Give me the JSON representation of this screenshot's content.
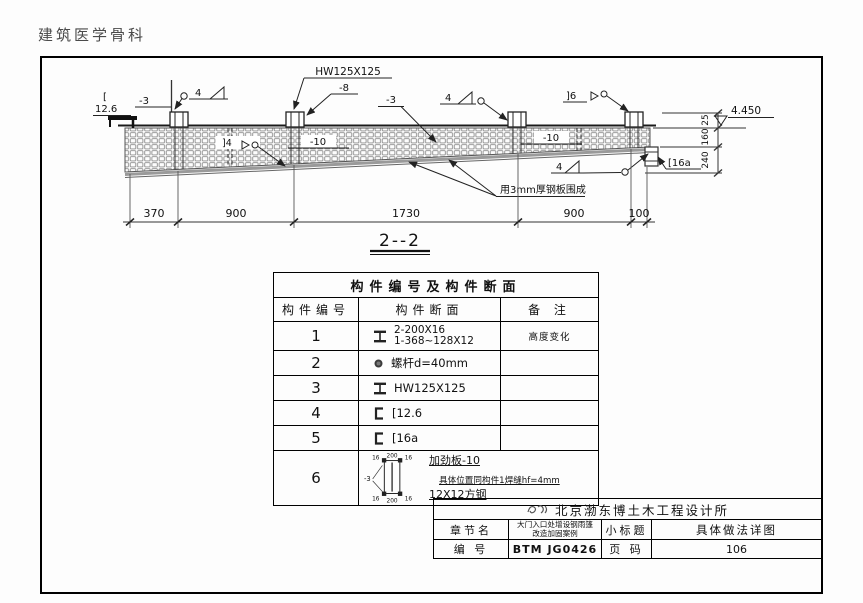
{
  "page": {
    "watermark": "建筑医学骨科"
  },
  "drawing": {
    "section_title": "2--2",
    "labels": {
      "bracket": "[",
      "c126": "12.6",
      "p3_left": "-3",
      "w4_left": "4",
      "hw": "HW125X125",
      "p8": "-8",
      "p3_mid": "-3",
      "w4_mid": "4",
      "j4": "]4",
      "p10_a": "-10",
      "p10_b": "-10",
      "j6": "]6",
      "w4_bottom": "4",
      "c16a": "[16a",
      "wrap_note": "用3mm厚钢板围成",
      "elevation": "4.450"
    },
    "h_dims": [
      "370",
      "900",
      "1730",
      "900",
      "100"
    ],
    "v_dims": [
      "25",
      "160",
      "240"
    ]
  },
  "table": {
    "title": "构件编号及构件断面",
    "col_no": "构件编号",
    "col_section": "构件断面",
    "col_remark": "备 注",
    "rows": [
      {
        "no": "1",
        "icon": "i-beam-icon",
        "line1": "2-200X16",
        "line2": "1-368~128X12",
        "remark": "高度变化"
      },
      {
        "no": "2",
        "icon": "bolt-icon",
        "line1": "螺杆d=40mm",
        "remark": ""
      },
      {
        "no": "3",
        "icon": "i-beam-icon",
        "line1": "HW125X125",
        "remark": ""
      },
      {
        "no": "4",
        "icon": "channel-icon",
        "line1": "[12.6",
        "remark": ""
      },
      {
        "no": "5",
        "icon": "channel-icon",
        "line1": "[16a",
        "remark": ""
      },
      {
        "no": "6",
        "icon": "box-section-sketch",
        "note1": "加劲板-10",
        "note2": "具体位置同构件1焊缝hf=4mm",
        "note3": "12X12方钢",
        "sketch": {
          "top_w": "200",
          "bot_w": "200",
          "t16": "16",
          "plate": "-3"
        }
      }
    ]
  },
  "title_block": {
    "company": "北京渤东博土木工程设计所",
    "chapter_label": "章节名",
    "chapter_line1": "大门入口处增设钢雨篷",
    "chapter_line2": "改造加固案例",
    "subtitle_label": "小标题",
    "subtitle_value": "具体做法详图",
    "number_label": "编 号",
    "number_value": "BTM JG0426",
    "page_label": "页 码",
    "page_value": "106"
  }
}
